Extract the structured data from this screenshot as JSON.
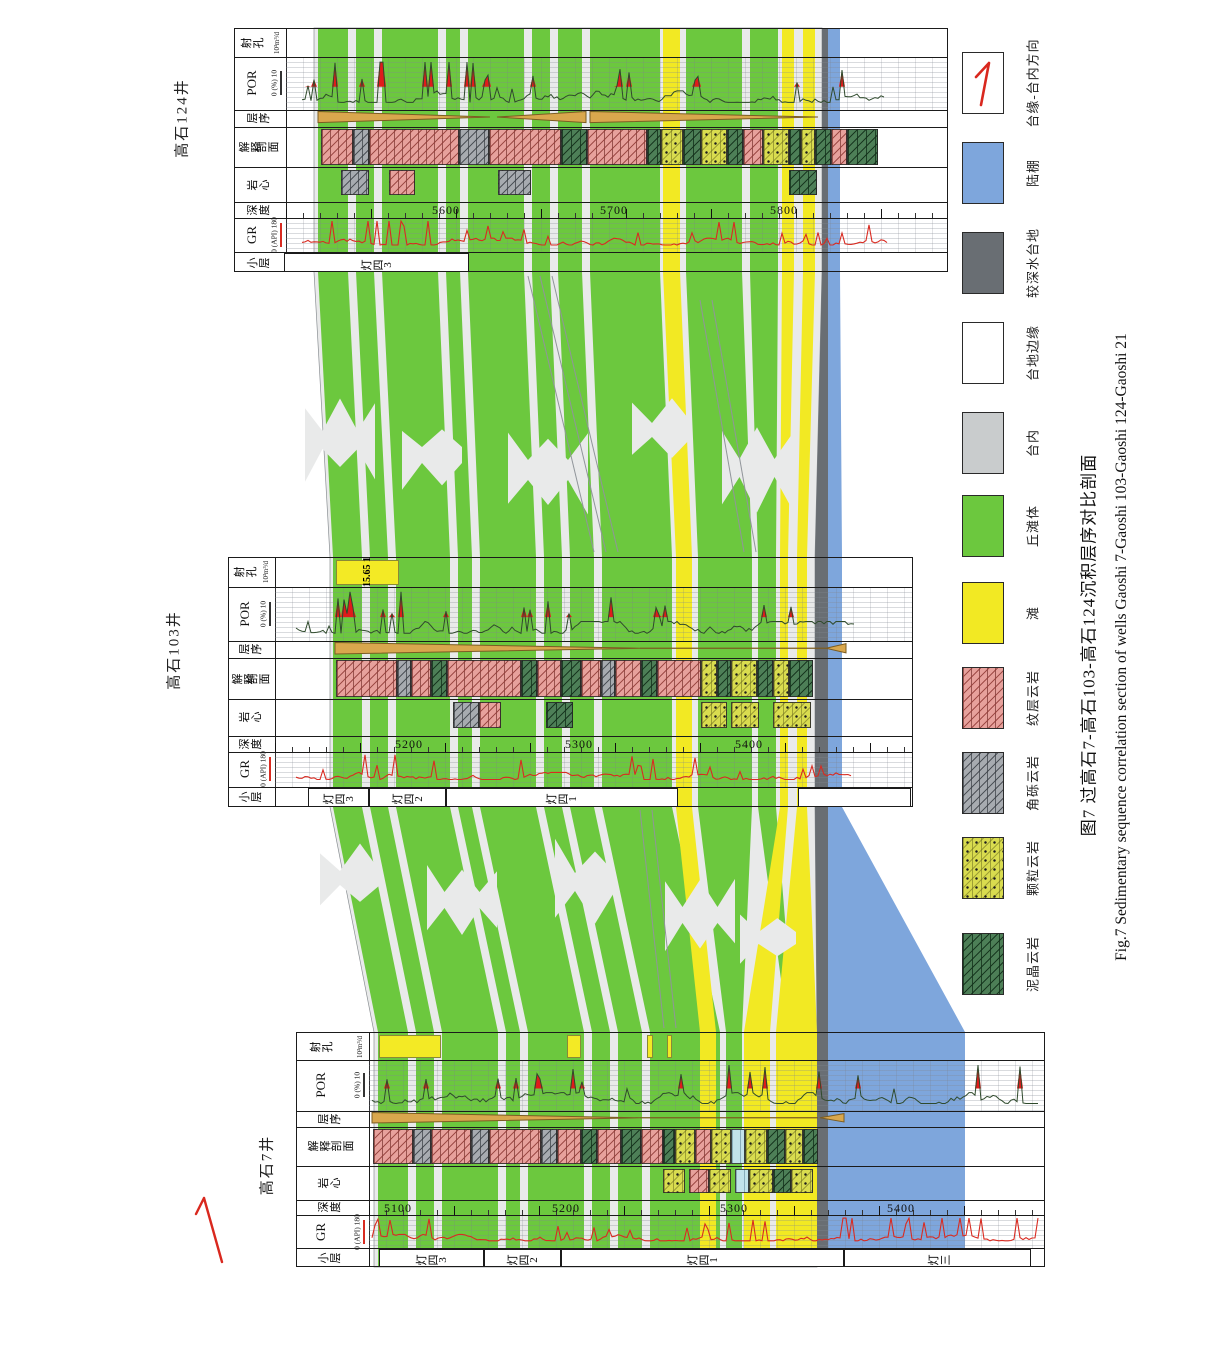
{
  "page": {
    "w": 1209,
    "h": 1349,
    "bg": "#ffffff"
  },
  "colors": {
    "green": "#6cc83e",
    "yellow": "#f2e923",
    "dkgray": "#696e73",
    "blue": "#7ea6dc",
    "field": "#e9eaea",
    "tan": "#d9a74d",
    "tanStroke": "#7b5c22",
    "grRed": "#d92b21",
    "porLine": "#2f4a2c",
    "porRed": "#e01b1b",
    "arrowRed": "#d9281e",
    "border": "#1b1b1b"
  },
  "tracks": {
    "rows": [
      {
        "key": "perf",
        "label": "射孔",
        "sub": "10³m³/d",
        "f0": 0.0,
        "f1": 0.115
      },
      {
        "key": "por",
        "label": "POR",
        "scale": "0  (%)  10",
        "f0": 0.115,
        "f1": 0.33
      },
      {
        "key": "seq",
        "label": "层序",
        "f0": 0.33,
        "f1": 0.4
      },
      {
        "key": "lith",
        "label": "解释剖面",
        "label2": "解释",
        "label3": "剖面",
        "f0": 0.4,
        "f1": 0.565
      },
      {
        "key": "core",
        "label": "岩心",
        "f0": 0.565,
        "f1": 0.71
      },
      {
        "key": "depth",
        "label": "深度",
        "f0": 0.71,
        "f1": 0.775
      },
      {
        "key": "gr",
        "label": "GR",
        "scale": "0  (API)  180",
        "f0": 0.775,
        "f1": 0.915
      },
      {
        "key": "sub",
        "label": "小层",
        "f0": 0.915,
        "f1": 1.0
      }
    ]
  },
  "panels": [
    {
      "id": "gs124",
      "name": "高石124井",
      "x0": 234,
      "x1": 948,
      "y0": 28,
      "y1": 272,
      "headerW": 51,
      "nameX": 181,
      "nameY": 118,
      "depths": [
        {
          "x": 445,
          "t": "5600"
        },
        {
          "x": 613,
          "t": "5700"
        },
        {
          "x": 783,
          "t": "5800"
        }
      ],
      "subzones": [
        {
          "x1": 283,
          "x2": 468,
          "t": "灯四3"
        }
      ],
      "perf": [],
      "lith": [
        [
          320,
          352,
          "pink"
        ],
        [
          352,
          368,
          "gray"
        ],
        [
          368,
          458,
          "pink"
        ],
        [
          458,
          488,
          "gray"
        ],
        [
          488,
          560,
          "pink"
        ],
        [
          560,
          586,
          "dgreen"
        ],
        [
          586,
          646,
          "pink"
        ],
        [
          646,
          660,
          "dgreen"
        ],
        [
          660,
          682,
          "grain"
        ],
        [
          682,
          700,
          "dgreen"
        ],
        [
          700,
          726,
          "grain"
        ],
        [
          726,
          742,
          "dgreen"
        ],
        [
          742,
          762,
          "pink"
        ],
        [
          762,
          788,
          "grain"
        ],
        [
          788,
          800,
          "dgreen"
        ],
        [
          800,
          814,
          "grain"
        ],
        [
          814,
          830,
          "dgreen"
        ],
        [
          830,
          846,
          "pink"
        ],
        [
          846,
          877,
          "dgreen"
        ]
      ],
      "core": [
        [
          340,
          368,
          "gray"
        ],
        [
          388,
          414,
          "pink"
        ],
        [
          497,
          530,
          "gray"
        ],
        [
          788,
          816,
          "dgreen"
        ]
      ],
      "wedges": [
        {
          "t": "tr",
          "x1": 318,
          "x2": 490
        },
        {
          "t": "tl",
          "x1": 497,
          "x2": 586
        },
        {
          "t": "tr",
          "x1": 590,
          "x2": 818
        }
      ],
      "gr": {
        "seed": 11,
        "x1": 302,
        "x2": 888,
        "win": [
          [
            302,
            430,
            1.6
          ],
          [
            430,
            888,
            1.0
          ]
        ]
      },
      "por": {
        "seed": 12,
        "x1": 302,
        "x2": 885,
        "win": [
          [
            330,
            480,
            1.8
          ],
          [
            480,
            700,
            1.0
          ],
          [
            700,
            860,
            0.85
          ],
          [
            860,
            885,
            0.4
          ]
        ]
      }
    },
    {
      "id": "gs103",
      "name": "高石103井",
      "x0": 228,
      "x1": 913,
      "y0": 557,
      "y1": 807,
      "headerW": 46,
      "nameX": 173,
      "nameY": 650,
      "depths": [
        {
          "x": 408,
          "t": "5200"
        },
        {
          "x": 578,
          "t": "5300"
        },
        {
          "x": 748,
          "t": "5400"
        }
      ],
      "subzones": [
        {
          "x1": 307,
          "x2": 368,
          "t": "灯四3"
        },
        {
          "x1": 368,
          "x2": 445,
          "t": "灯四2"
        },
        {
          "x1": 445,
          "x2": 677,
          "t": "灯四1"
        },
        {
          "x1": 797,
          "x2": 910,
          "t": ""
        }
      ],
      "perf": [
        {
          "x1": 335,
          "x2": 398,
          "labeled": true
        }
      ],
      "lith": [
        [
          335,
          396,
          "pink"
        ],
        [
          396,
          410,
          "gray"
        ],
        [
          410,
          430,
          "pink"
        ],
        [
          430,
          446,
          "dgreen"
        ],
        [
          446,
          520,
          "pink"
        ],
        [
          520,
          536,
          "dgreen"
        ],
        [
          536,
          560,
          "pink"
        ],
        [
          560,
          580,
          "dgreen"
        ],
        [
          580,
          600,
          "pink"
        ],
        [
          600,
          614,
          "gray"
        ],
        [
          614,
          640,
          "pink"
        ],
        [
          640,
          656,
          "dgreen"
        ],
        [
          656,
          700,
          "pink"
        ],
        [
          700,
          716,
          "grain"
        ],
        [
          716,
          730,
          "dgreen"
        ],
        [
          730,
          756,
          "grain"
        ],
        [
          756,
          772,
          "dgreen"
        ],
        [
          772,
          788,
          "grain"
        ],
        [
          788,
          812,
          "dgreen"
        ]
      ],
      "core": [
        [
          452,
          478,
          "gray"
        ],
        [
          478,
          500,
          "pink"
        ],
        [
          545,
          572,
          "dgreen"
        ],
        [
          700,
          726,
          "grain"
        ],
        [
          730,
          758,
          "grain"
        ],
        [
          772,
          810,
          "grain"
        ]
      ],
      "wedges": [
        {
          "t": "tr",
          "x1": 335,
          "x2": 640
        },
        {
          "t": "ln",
          "x1": 640,
          "x2": 826
        },
        {
          "t": "sl",
          "x1": 826,
          "x2": 846
        }
      ],
      "gr": {
        "seed": 21,
        "x1": 296,
        "x2": 852,
        "win": [
          [
            330,
            430,
            1.7
          ],
          [
            430,
            852,
            1.0
          ]
        ]
      },
      "por": {
        "seed": 22,
        "x1": 296,
        "x2": 855,
        "win": [
          [
            335,
            430,
            1.8
          ],
          [
            430,
            800,
            1.0
          ],
          [
            800,
            855,
            0.5
          ]
        ]
      }
    },
    {
      "id": "gs7",
      "name": "高石7井",
      "x0": 296,
      "x1": 1045,
      "y0": 1032,
      "y1": 1267,
      "headerW": 72,
      "nameX": 266,
      "nameY": 1165,
      "depths": [
        {
          "x": 397,
          "t": "5100"
        },
        {
          "x": 565,
          "t": "5200"
        },
        {
          "x": 733,
          "t": "5300"
        },
        {
          "x": 900,
          "t": "5400"
        }
      ],
      "subzones": [
        {
          "x1": 378,
          "x2": 483,
          "t": "灯四3"
        },
        {
          "x1": 483,
          "x2": 560,
          "t": "灯四2"
        },
        {
          "x1": 560,
          "x2": 843,
          "t": "灯四1"
        },
        {
          "x1": 843,
          "x2": 1030,
          "t": "灯三"
        }
      ],
      "perf": [
        {
          "x1": 378,
          "x2": 440
        },
        {
          "x1": 566,
          "x2": 580
        },
        {
          "x1": 646,
          "x2": 652
        },
        {
          "x1": 666,
          "x2": 671
        }
      ],
      "lith": [
        [
          372,
          412,
          "pink"
        ],
        [
          412,
          430,
          "gray"
        ],
        [
          430,
          470,
          "pink"
        ],
        [
          470,
          488,
          "gray"
        ],
        [
          488,
          540,
          "pink"
        ],
        [
          540,
          556,
          "gray"
        ],
        [
          556,
          580,
          "pink"
        ],
        [
          580,
          596,
          "dgreen"
        ],
        [
          596,
          620,
          "pink"
        ],
        [
          620,
          640,
          "dgreen"
        ],
        [
          640,
          662,
          "pink"
        ],
        [
          662,
          674,
          "dgreen"
        ],
        [
          674,
          694,
          "grain"
        ],
        [
          694,
          710,
          "pink"
        ],
        [
          710,
          730,
          "grain"
        ],
        [
          730,
          744,
          "lblue"
        ],
        [
          744,
          766,
          "grain"
        ],
        [
          766,
          784,
          "dgreen"
        ],
        [
          784,
          802,
          "grain"
        ],
        [
          802,
          817,
          "dgreen"
        ]
      ],
      "core": [
        [
          662,
          684,
          "grain"
        ],
        [
          688,
          708,
          "pink"
        ],
        [
          708,
          730,
          "grain"
        ],
        [
          734,
          748,
          "lblue"
        ],
        [
          748,
          772,
          "grain"
        ],
        [
          772,
          790,
          "dgreen"
        ],
        [
          790,
          812,
          "grain"
        ]
      ],
      "wedges": [
        {
          "t": "tr",
          "x1": 372,
          "x2": 640
        },
        {
          "t": "ln",
          "x1": 640,
          "x2": 818
        },
        {
          "t": "sl",
          "x1": 820,
          "x2": 844
        }
      ],
      "gr": {
        "seed": 31,
        "x1": 372,
        "x2": 1040,
        "win": [
          [
            372,
            820,
            1.0
          ],
          [
            820,
            1040,
            2.2
          ]
        ]
      },
      "por": {
        "seed": 32,
        "x1": 372,
        "x2": 1040,
        "win": [
          [
            372,
            500,
            1.6
          ],
          [
            500,
            860,
            1.0
          ],
          [
            860,
            1040,
            1.15
          ]
        ]
      }
    }
  ],
  "zones": {
    "ys": [
      28,
      272,
      557,
      807,
      1032,
      1267
    ],
    "field": {
      "a": [
        314,
        822
      ],
      "b": [
        330,
        815
      ],
      "cc": [
        374,
        817
      ]
    },
    "stripes": [
      {
        "c": "green",
        "a": [
          318,
          348
        ],
        "b": [
          333,
          362
        ],
        "cc": [
          378,
          408
        ]
      },
      {
        "c": "green",
        "a": [
          356,
          374
        ],
        "b": [
          370,
          388
        ],
        "cc": [
          416,
          434
        ]
      },
      {
        "c": "green",
        "a": [
          382,
          438
        ],
        "b": [
          396,
          450
        ],
        "cc": [
          442,
          498
        ]
      },
      {
        "c": "green",
        "a": [
          446,
          460
        ],
        "b": [
          458,
          472
        ],
        "cc": [
          506,
          520
        ]
      },
      {
        "c": "green",
        "a": [
          468,
          524
        ],
        "b": [
          480,
          536
        ],
        "cc": [
          528,
          584
        ]
      },
      {
        "c": "green",
        "a": [
          532,
          550
        ],
        "b": [
          544,
          562
        ],
        "cc": [
          592,
          610
        ]
      },
      {
        "c": "green",
        "a": [
          558,
          582
        ],
        "b": [
          570,
          594
        ],
        "cc": [
          618,
          642
        ]
      },
      {
        "c": "green",
        "a": [
          590,
          660
        ],
        "b": [
          602,
          672
        ],
        "cc": [
          650,
          720
        ]
      },
      {
        "c": "green",
        "a": [
          686,
          742
        ],
        "b": [
          698,
          752
        ],
        "cc": [
          726,
          742
        ]
      },
      {
        "c": "green",
        "a": [
          750,
          778
        ],
        "b": [
          758,
          776
        ],
        "cc": [
          788,
          794
        ]
      },
      {
        "c": "yellow",
        "a": [
          663,
          680
        ],
        "b": [
          676,
          692
        ],
        "cc": [
          700,
          716
        ]
      },
      {
        "c": "yellow",
        "a": [
          782,
          794
        ],
        "b": [
          780,
          788
        ],
        "cc": [
          744,
          770
        ]
      },
      {
        "c": "yellow",
        "a": [
          803,
          815
        ],
        "b": [
          797,
          807
        ],
        "cc": [
          776,
          817
        ]
      },
      {
        "c": "dkgray",
        "a": [
          822,
          828
        ],
        "b": [
          815,
          828
        ],
        "cc": [
          817,
          828
        ]
      }
    ],
    "blue": {
      "left": 828,
      "a": 840,
      "b": 842,
      "c": 965
    },
    "pinches": [
      [
        340,
        440,
        70,
        90
      ],
      [
        432,
        455,
        60,
        80
      ],
      [
        548,
        470,
        80,
        100
      ],
      [
        662,
        430,
        60,
        70
      ],
      [
        757,
        468,
        70,
        90
      ],
      [
        350,
        878,
        60,
        70
      ],
      [
        462,
        900,
        70,
        80
      ],
      [
        585,
        882,
        60,
        90
      ],
      [
        700,
        915,
        70,
        80
      ],
      [
        768,
        938,
        56,
        60
      ]
    ],
    "bundles": [
      [
        528,
        276,
        594,
        552
      ],
      [
        540,
        276,
        606,
        552
      ],
      [
        552,
        276,
        618,
        552
      ],
      [
        700,
        300,
        744,
        552
      ],
      [
        712,
        300,
        756,
        552
      ],
      [
        640,
        810,
        664,
        1028
      ],
      [
        652,
        810,
        676,
        1028
      ]
    ]
  },
  "legend": {
    "x": 962,
    "boxW": 42,
    "boxH": 62,
    "labelX": 1032,
    "items": [
      {
        "swatch": "direction",
        "label": "台缘-台内方向",
        "y": 52
      },
      {
        "swatch": "solid-blue",
        "label": "陆棚",
        "y": 142
      },
      {
        "swatch": "solid-dkgray",
        "label": "较深水台地",
        "y": 232
      },
      {
        "swatch": "solid-white",
        "label": "台地边缘",
        "y": 322
      },
      {
        "swatch": "solid-ltgray",
        "label": "台内",
        "y": 412
      },
      {
        "swatch": "solid-green",
        "label": "丘滩体",
        "y": 495
      },
      {
        "swatch": "solid-yellow",
        "label": "滩",
        "y": 582
      },
      {
        "swatch": "pink",
        "label": "纹层云岩",
        "y": 667
      },
      {
        "swatch": "gray",
        "label": "角砾云岩",
        "y": 752
      },
      {
        "swatch": "grain",
        "label": "颗粒云岩",
        "y": 837
      },
      {
        "swatch": "dgreen",
        "label": "泥晶云岩",
        "y": 933
      }
    ]
  },
  "captions": {
    "zh": "图7  过高石7-高石103-高石124沉积层序对比剖面",
    "en": "Fig.7  Sedimentary sequence correlation section of wells Gaoshi 7-Gaoshi 103-Gaoshi 124-Gaoshi 21"
  },
  "perf_label": {
    "line1": "15.65",
    "line2": "1"
  },
  "direction_arrow": {
    "x1": 222,
    "y1": 1262,
    "x2": 204,
    "y2": 1198
  }
}
